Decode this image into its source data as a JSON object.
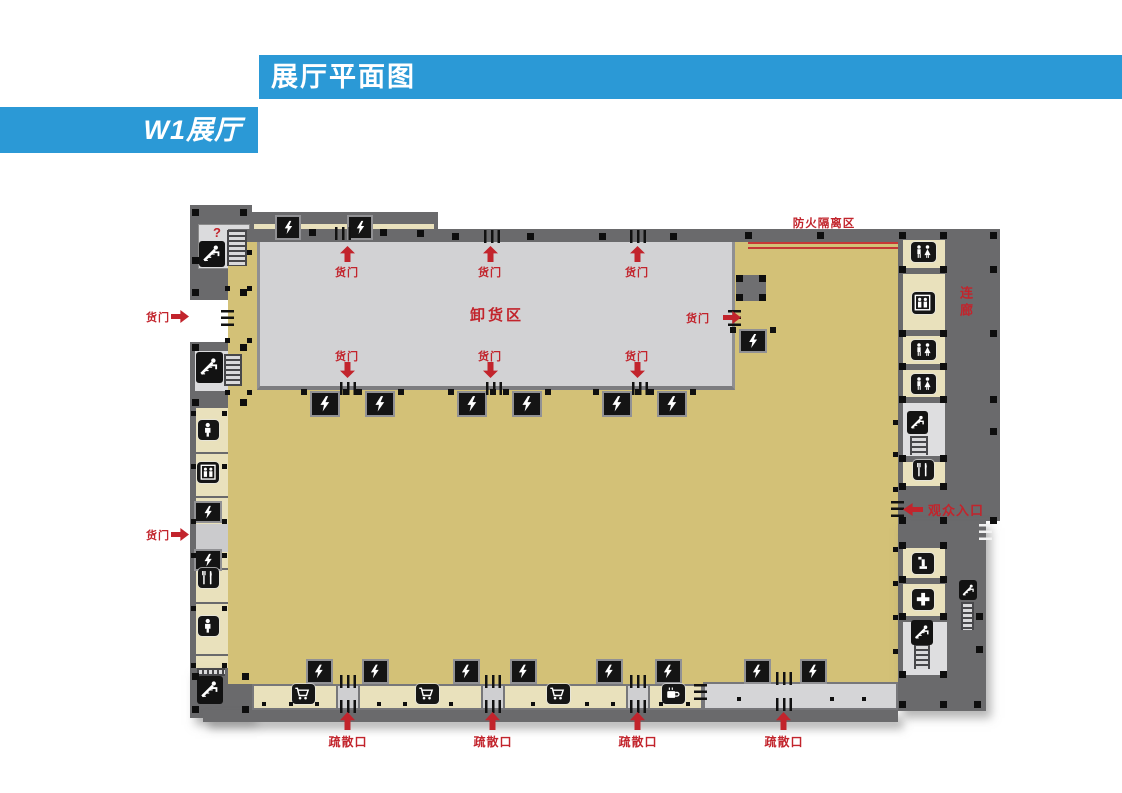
{
  "header": {
    "title": "展厅平面图",
    "hall_label": "W1展厅"
  },
  "colors": {
    "accent_blue": "#2B99D6",
    "label_red": "#C2242C",
    "hall_tan": "#D3C177",
    "room_beige": "#E9E1BC",
    "wall_gray": "#6A6A6C",
    "unloading_gray": "#D2D2D4",
    "fire_line_red": "#C63737"
  },
  "plan": {
    "unloading_area_label": "卸货区",
    "cargo_door_label": "货门",
    "evacuation_exit_label": "疏散口",
    "fire_isolation_label": "防火隔离区",
    "corridor_label": "连廊",
    "visitor_entrance_label": "观众入口",
    "information_mark": "?"
  },
  "icons": {
    "electrical_panel": "lightning-bolt",
    "escalator": "escalator-figure",
    "stairs": "ladder-hatch",
    "elevator": "two-persons-in-box",
    "restroom": "man-woman-figures",
    "toilet": "person-figure",
    "restaurant": "fork-and-knife",
    "shop": "shopping-cart",
    "cafe": "coffee-cup",
    "first_aid": "medical-cross",
    "drinking_water": "fountain",
    "information": "question-mark"
  }
}
